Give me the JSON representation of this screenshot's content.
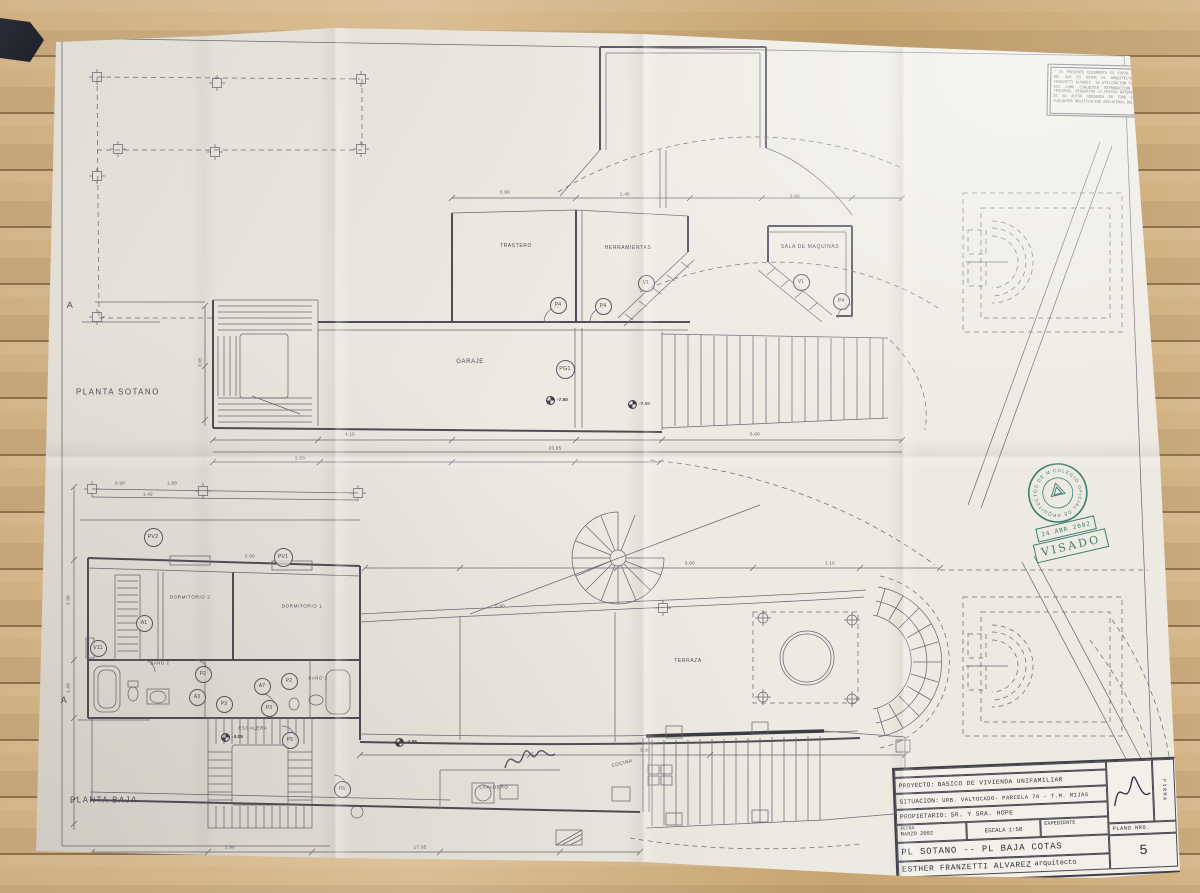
{
  "scene": {
    "wood_color": "#c8a572",
    "paper_color": "#edeae2",
    "line_color": "#5f5f6b",
    "stamp_color": "#2f7566"
  },
  "plan_sotano": {
    "title": "PLANTA SOTANO",
    "section_letter": "A",
    "rooms": {
      "trastero": "TRASTERO",
      "herramientas": "HERRAMIENTAS",
      "sala_maquinas": "SALA DE MAQUINAS",
      "garaje": "GARAJE"
    },
    "markers": {
      "p4_1": "P4",
      "p4_2": "P4",
      "v1_1": "V1",
      "v1_2": "V1",
      "p4_3": "P4",
      "pg1": "PG1"
    },
    "levels": {
      "l1": "-7.50",
      "l2": "-7.50"
    }
  },
  "plan_baja": {
    "title": "PLANTA BAJA",
    "section_letter": "A",
    "rooms": {
      "dormitorio2": "DORMITORIO 2",
      "dormitorio1": "DORMITORIO 1",
      "bano2": "BAÑO 2",
      "bano1": "BAÑO 1",
      "escalera": "ESCALERA",
      "terraza": "TERRAZA",
      "lavadero": "LAVADERO",
      "cocina": "COCINA"
    },
    "markers": {
      "pv2": "PV2",
      "pv1": "PV1",
      "a1": "A1",
      "v11": "V11",
      "p2_1": "P2",
      "a3": "A3",
      "p3_1": "P3",
      "a7": "A7",
      "p3_2": "P3",
      "p2_2": "P2",
      "p5": "P5",
      "p6": "P6"
    },
    "levels": {
      "l1": "-3.05",
      "l2": "-4.55"
    }
  },
  "dims": [
    "5.90",
    "2.45",
    "5.90",
    "4.10",
    "23.95",
    "5.00",
    "3.05",
    "3.90",
    "1.40",
    "0.90",
    "1.80",
    "1.42",
    "5.90",
    "17.35",
    "5.60",
    "2.10",
    "5.90",
    "3.90",
    "2.80",
    "1.90"
  ],
  "note_box": {
    "text": "\" EL PRESENTE DOCUMENTO ES COPIA DE SU ORIGINAL DEL QUE ES AUTOR EL ARQUITECTO DOÑA ESTHER FRANZETTI ALVAREZ. SU UTILIZACION TOTAL O PARCIAL, ASI COMO CUALQUIER REPRODUCCION O CESION A TERCEROS, REQUERIRA LA PREVIA AUTORIZACION EXPRESA DE SU AUTOR QUEDANDO EN TODO CASO PROHIBIDA CUALQUIER MODIFICACION UNILATERAL DEL MISMO.\""
  },
  "stamp": {
    "ring_text": "COLEGIO OFICIAL DE ARQUITECTOS DE MALAGA",
    "date": "24 ABR 2002",
    "label": "VISADO"
  },
  "title_block": {
    "proyecto_label": "PROYECTO:",
    "proyecto_value": "BASICO DE VIVIENDA UNIFAMILIAR",
    "situacion_label": "SITUACION:",
    "situacion_value": "URB. VALTOCADO- PARCELA 70 - T.M. MIJAS",
    "propietario_label": "PROPIETARIO:",
    "propietario_value": "SR. Y SRA. HOPE",
    "fecha_label": "FECHA",
    "fecha_value": "MARZO 2002",
    "escala_label": "ESCALA",
    "escala_value": "1:50",
    "expediente_label": "EXPEDIENTE",
    "plano_label": "PLANO NRO.",
    "plano_number": "5",
    "sheet_title": "PL SOTANO -- PL BAJA COTAS",
    "architect_name": "ESTHER FRANZETTI ALVAREZ",
    "architect_role": "arquitecto",
    "firma_label": "FIRMA"
  }
}
